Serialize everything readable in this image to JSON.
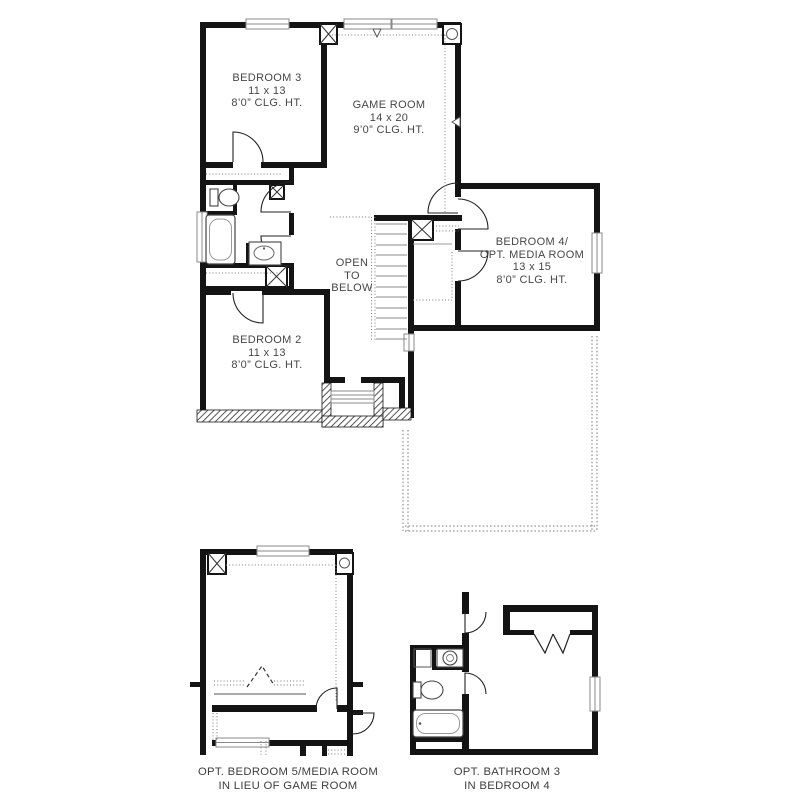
{
  "colors": {
    "background": "#ffffff",
    "wall": "#141414",
    "thin_line": "#555555",
    "window_line": "#8a8a8a",
    "dotted_line": "#777777",
    "hatch_line": "#2a2a2a",
    "text": "#474747"
  },
  "icons": {
    "section-marker-down-icon": "▽",
    "section-marker-left-icon": "◁",
    "column-box-x-icon": "☒",
    "column-box-round-icon": "◎"
  },
  "rooms": {
    "bedroom3": {
      "name": "BEDROOM 3",
      "dims": "11 x 13",
      "ceiling": "8’0” CLG. HT."
    },
    "game_room": {
      "name": "GAME ROOM",
      "dims": "14 x 20",
      "ceiling": "9’0” CLG. HT."
    },
    "bedroom4": {
      "name": "BEDROOM 4/",
      "name2": "OPT. MEDIA ROOM",
      "dims": "13 x 15",
      "ceiling": "8’0” CLG. HT."
    },
    "bedroom2": {
      "name": "BEDROOM 2",
      "dims": "11 x 13",
      "ceiling": "8’0” CLG. HT."
    },
    "stairwell": {
      "line1": "OPEN",
      "line2": "TO",
      "line3": "BELOW"
    }
  },
  "options": {
    "bedroom5": {
      "caption1": "OPT. BEDROOM 5/MEDIA ROOM",
      "caption2": "IN LIEU OF GAME ROOM"
    },
    "bathroom3": {
      "caption1": "OPT. BATHROOM 3",
      "caption2": "IN BEDROOM 4"
    }
  }
}
